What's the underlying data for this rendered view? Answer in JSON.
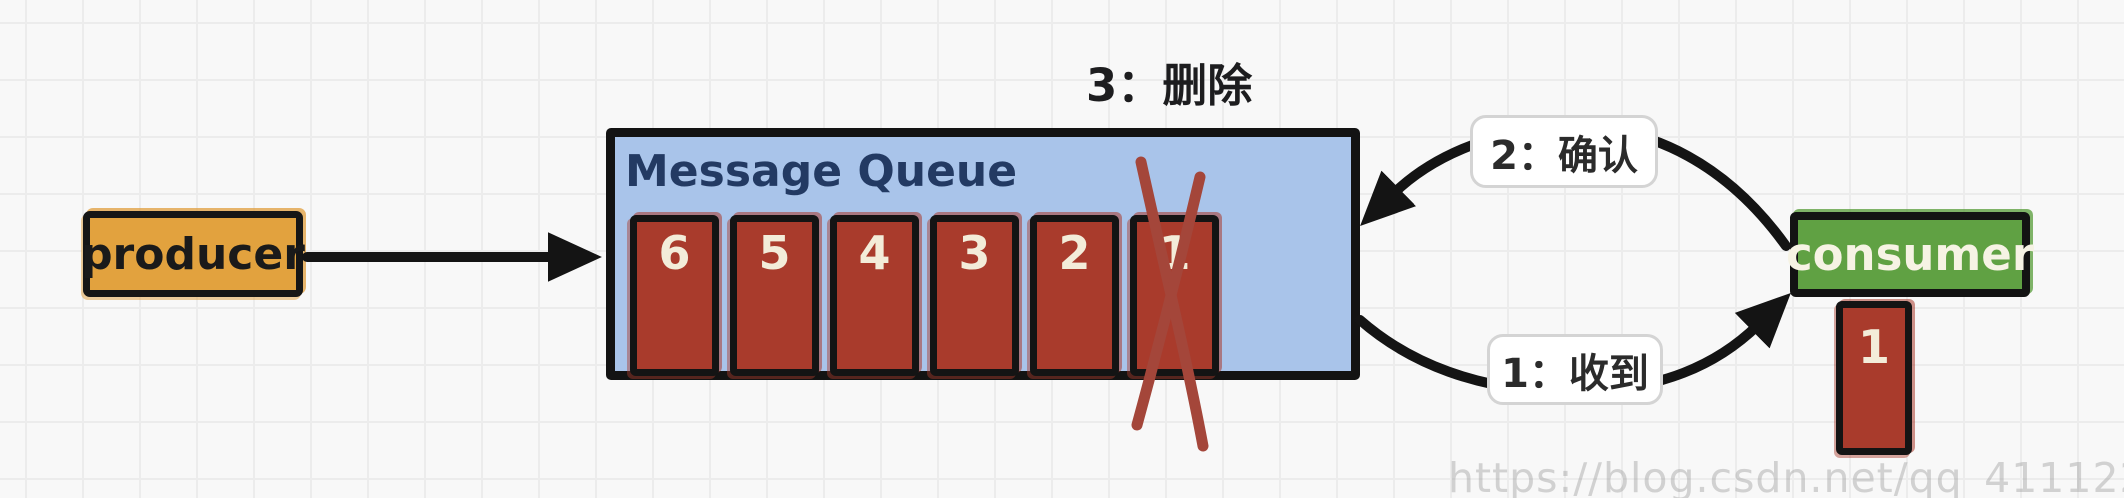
{
  "producer": {
    "label": "producer"
  },
  "queue": {
    "title": "Message Queue",
    "messages": [
      "6",
      "5",
      "4",
      "3",
      "2",
      "1"
    ],
    "crossed_out_message": "1"
  },
  "consumer": {
    "label": "consumer",
    "received_message": "1"
  },
  "annotations": {
    "delete_label": "3：删除",
    "ack_label": "2：确认",
    "receive_label": "1：收到"
  },
  "watermark": "https://blog.csdn.net/qq_41112238",
  "colors": {
    "producer_fill": "#e2a23e",
    "queue_fill": "#a9c4ea",
    "queue_title_text": "#233a63",
    "message_fill": "#a93b2c",
    "message_text": "#f3ecd9",
    "consumer_fill": "#60a143",
    "consumer_text": "#f6f3e4",
    "arrow": "#141414",
    "cross": "#a4463a",
    "label_text": "#2b2b2b",
    "watermark_text": "#dedede"
  }
}
